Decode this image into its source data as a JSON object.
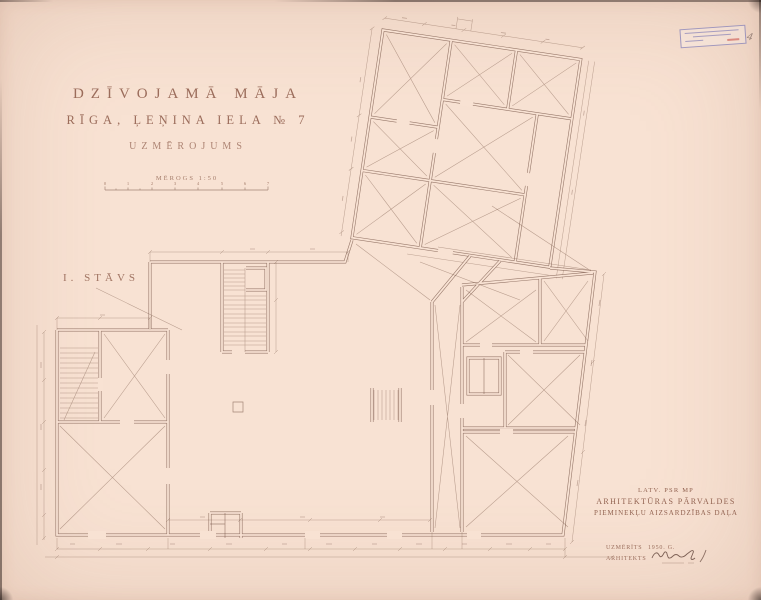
{
  "colors": {
    "paper": "#f8e2d3",
    "ink": "#8d6353",
    "stamp_blue": "#5a5aaa",
    "stamp_red": "#c84638"
  },
  "title_block": {
    "line1": "DZĪVOJAMĀ MĀJA",
    "line2": "RĪGA, ĻEŅINA IELA № 7",
    "line3": "UZMĒROJUMS"
  },
  "scale": {
    "label": "MĒROGS 1:50",
    "ticks": [
      "0",
      "1",
      "2",
      "3",
      "4",
      "5",
      "6",
      "7"
    ]
  },
  "floor_label": "I. STĀVS",
  "agency_block": {
    "line1": "LATV. PSR MP",
    "line2": "ARHITEKTŪRAS PĀRVALDES",
    "line3": "PIEMINEKĻU AIZSARDZĪBAS DAĻA"
  },
  "signature_block": {
    "measured_label": "UZMĒRĪTS",
    "measured_value": "1950. G.",
    "architect_label": "ARHITEKTS"
  },
  "stamp": {
    "handwritten_mark": "4"
  }
}
